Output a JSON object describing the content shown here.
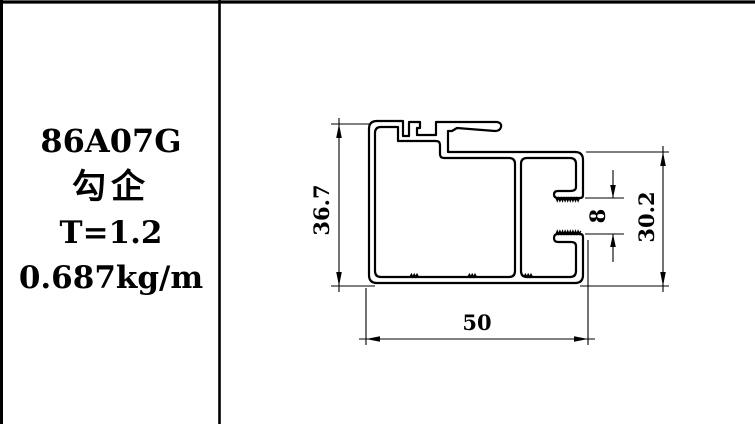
{
  "panel": {
    "model": "86A07G",
    "product_name": "勾企",
    "thickness": "T=1.2",
    "unit_weight": "0.687kg/m"
  },
  "dimensions": {
    "overall_height": "36.7",
    "slot_gap": "8",
    "right_side_height": "30.2",
    "overall_width": "50"
  },
  "colors": {
    "line": "#000000",
    "background": "#ffffff"
  }
}
